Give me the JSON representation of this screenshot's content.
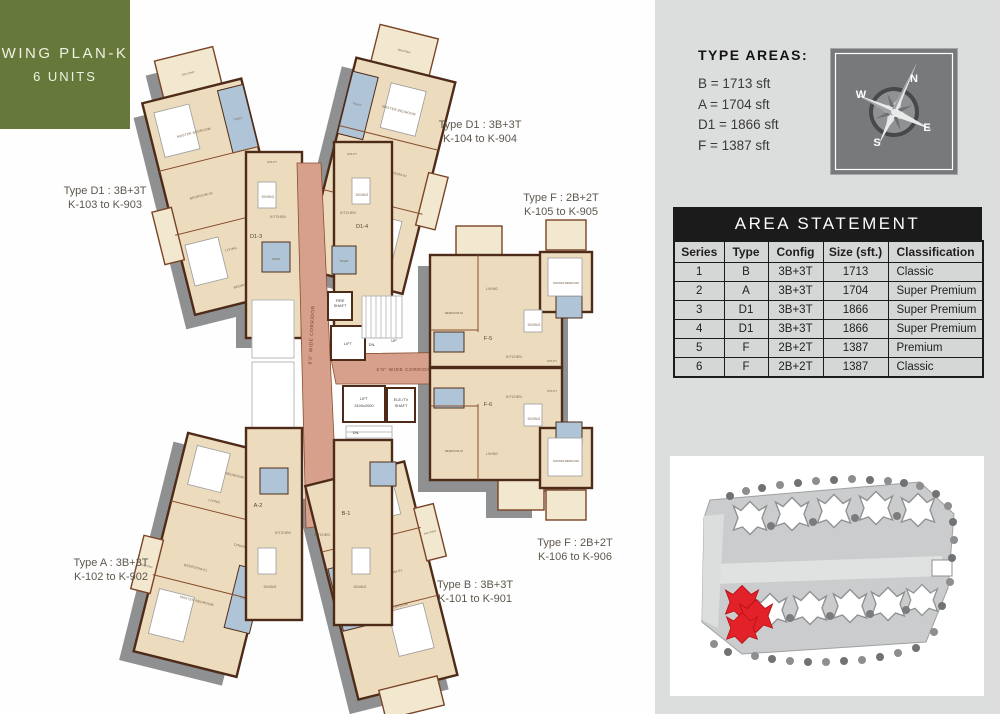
{
  "badge": {
    "line1": "WING PLAN-K",
    "line2": "6 UNITS"
  },
  "type_areas": {
    "title": "TYPE AREAS:",
    "items": [
      "B = 1713 sft",
      "A = 1704 sft",
      "D1 = 1866 sft",
      "F = 1387 sft"
    ]
  },
  "compass": {
    "n": "N",
    "e": "E",
    "s": "S",
    "w": "W"
  },
  "area_statement": {
    "title": "AREA STATEMENT",
    "columns": [
      "Series",
      "Type",
      "Config",
      "Size (sft.)",
      "Classification"
    ],
    "rows": [
      [
        "1",
        "B",
        "3B+3T",
        "1713",
        "Classic"
      ],
      [
        "2",
        "A",
        "3B+3T",
        "1704",
        "Super Premium"
      ],
      [
        "3",
        "D1",
        "3B+3T",
        "1866",
        "Super Premium"
      ],
      [
        "4",
        "D1",
        "3B+3T",
        "1866",
        "Super Premium"
      ],
      [
        "5",
        "F",
        "2B+2T",
        "1387",
        "Premium"
      ],
      [
        "6",
        "F",
        "2B+2T",
        "1387",
        "Classic"
      ]
    ]
  },
  "plan": {
    "unit_labels": [
      {
        "line1": "Type D1 : 3B+3T",
        "line2": "K-103 to K-903"
      },
      {
        "line1": "Type D1 : 3B+3T",
        "line2": "K-104 to K-904"
      },
      {
        "line1": "Type F : 2B+2T",
        "line2": "K-105 to K-905"
      },
      {
        "line1": "Type F : 2B+2T",
        "line2": "K-106 to K-906"
      },
      {
        "line1": "Type A : 3B+3T",
        "line2": "K-102 to K-902"
      },
      {
        "line1": "Type B : 3B+3T",
        "line2": "K-101 to K-901"
      }
    ],
    "units": {
      "d13": "D1-3",
      "d14": "D1-4",
      "a2": "A-2",
      "b1": "B-1",
      "f5": "F-5",
      "f6": "F-6"
    },
    "rooms": [
      "MASTER BEDROOM",
      "BEDROOM-01",
      "BEDROOM-02",
      "BEDROOM-03",
      "LIVING",
      "DINING",
      "KITCHEN",
      "TOILET",
      "BALCONY",
      "UTILITY"
    ],
    "core": {
      "corridor": "6'0\" WIDE CORRIDOR",
      "lift": "LIFT",
      "lift_size": "3100x2000",
      "ele1": "ELE./TV",
      "ele2": "SHAFT",
      "fire1": "FIRE",
      "fire2": "SHAFT",
      "up": "UP",
      "dn": "DN."
    }
  },
  "colors": {
    "badge_green": "#66793b",
    "panel_gray": "#dcdddd",
    "corridor_salmon": "#d6a08d",
    "room_beige": "#ecdcbd",
    "wall_brown": "#4e2b19",
    "toilet_blue": "#afc5d7",
    "site_highlight_red": "#e32128",
    "table_header_black": "#1b1b1b"
  }
}
